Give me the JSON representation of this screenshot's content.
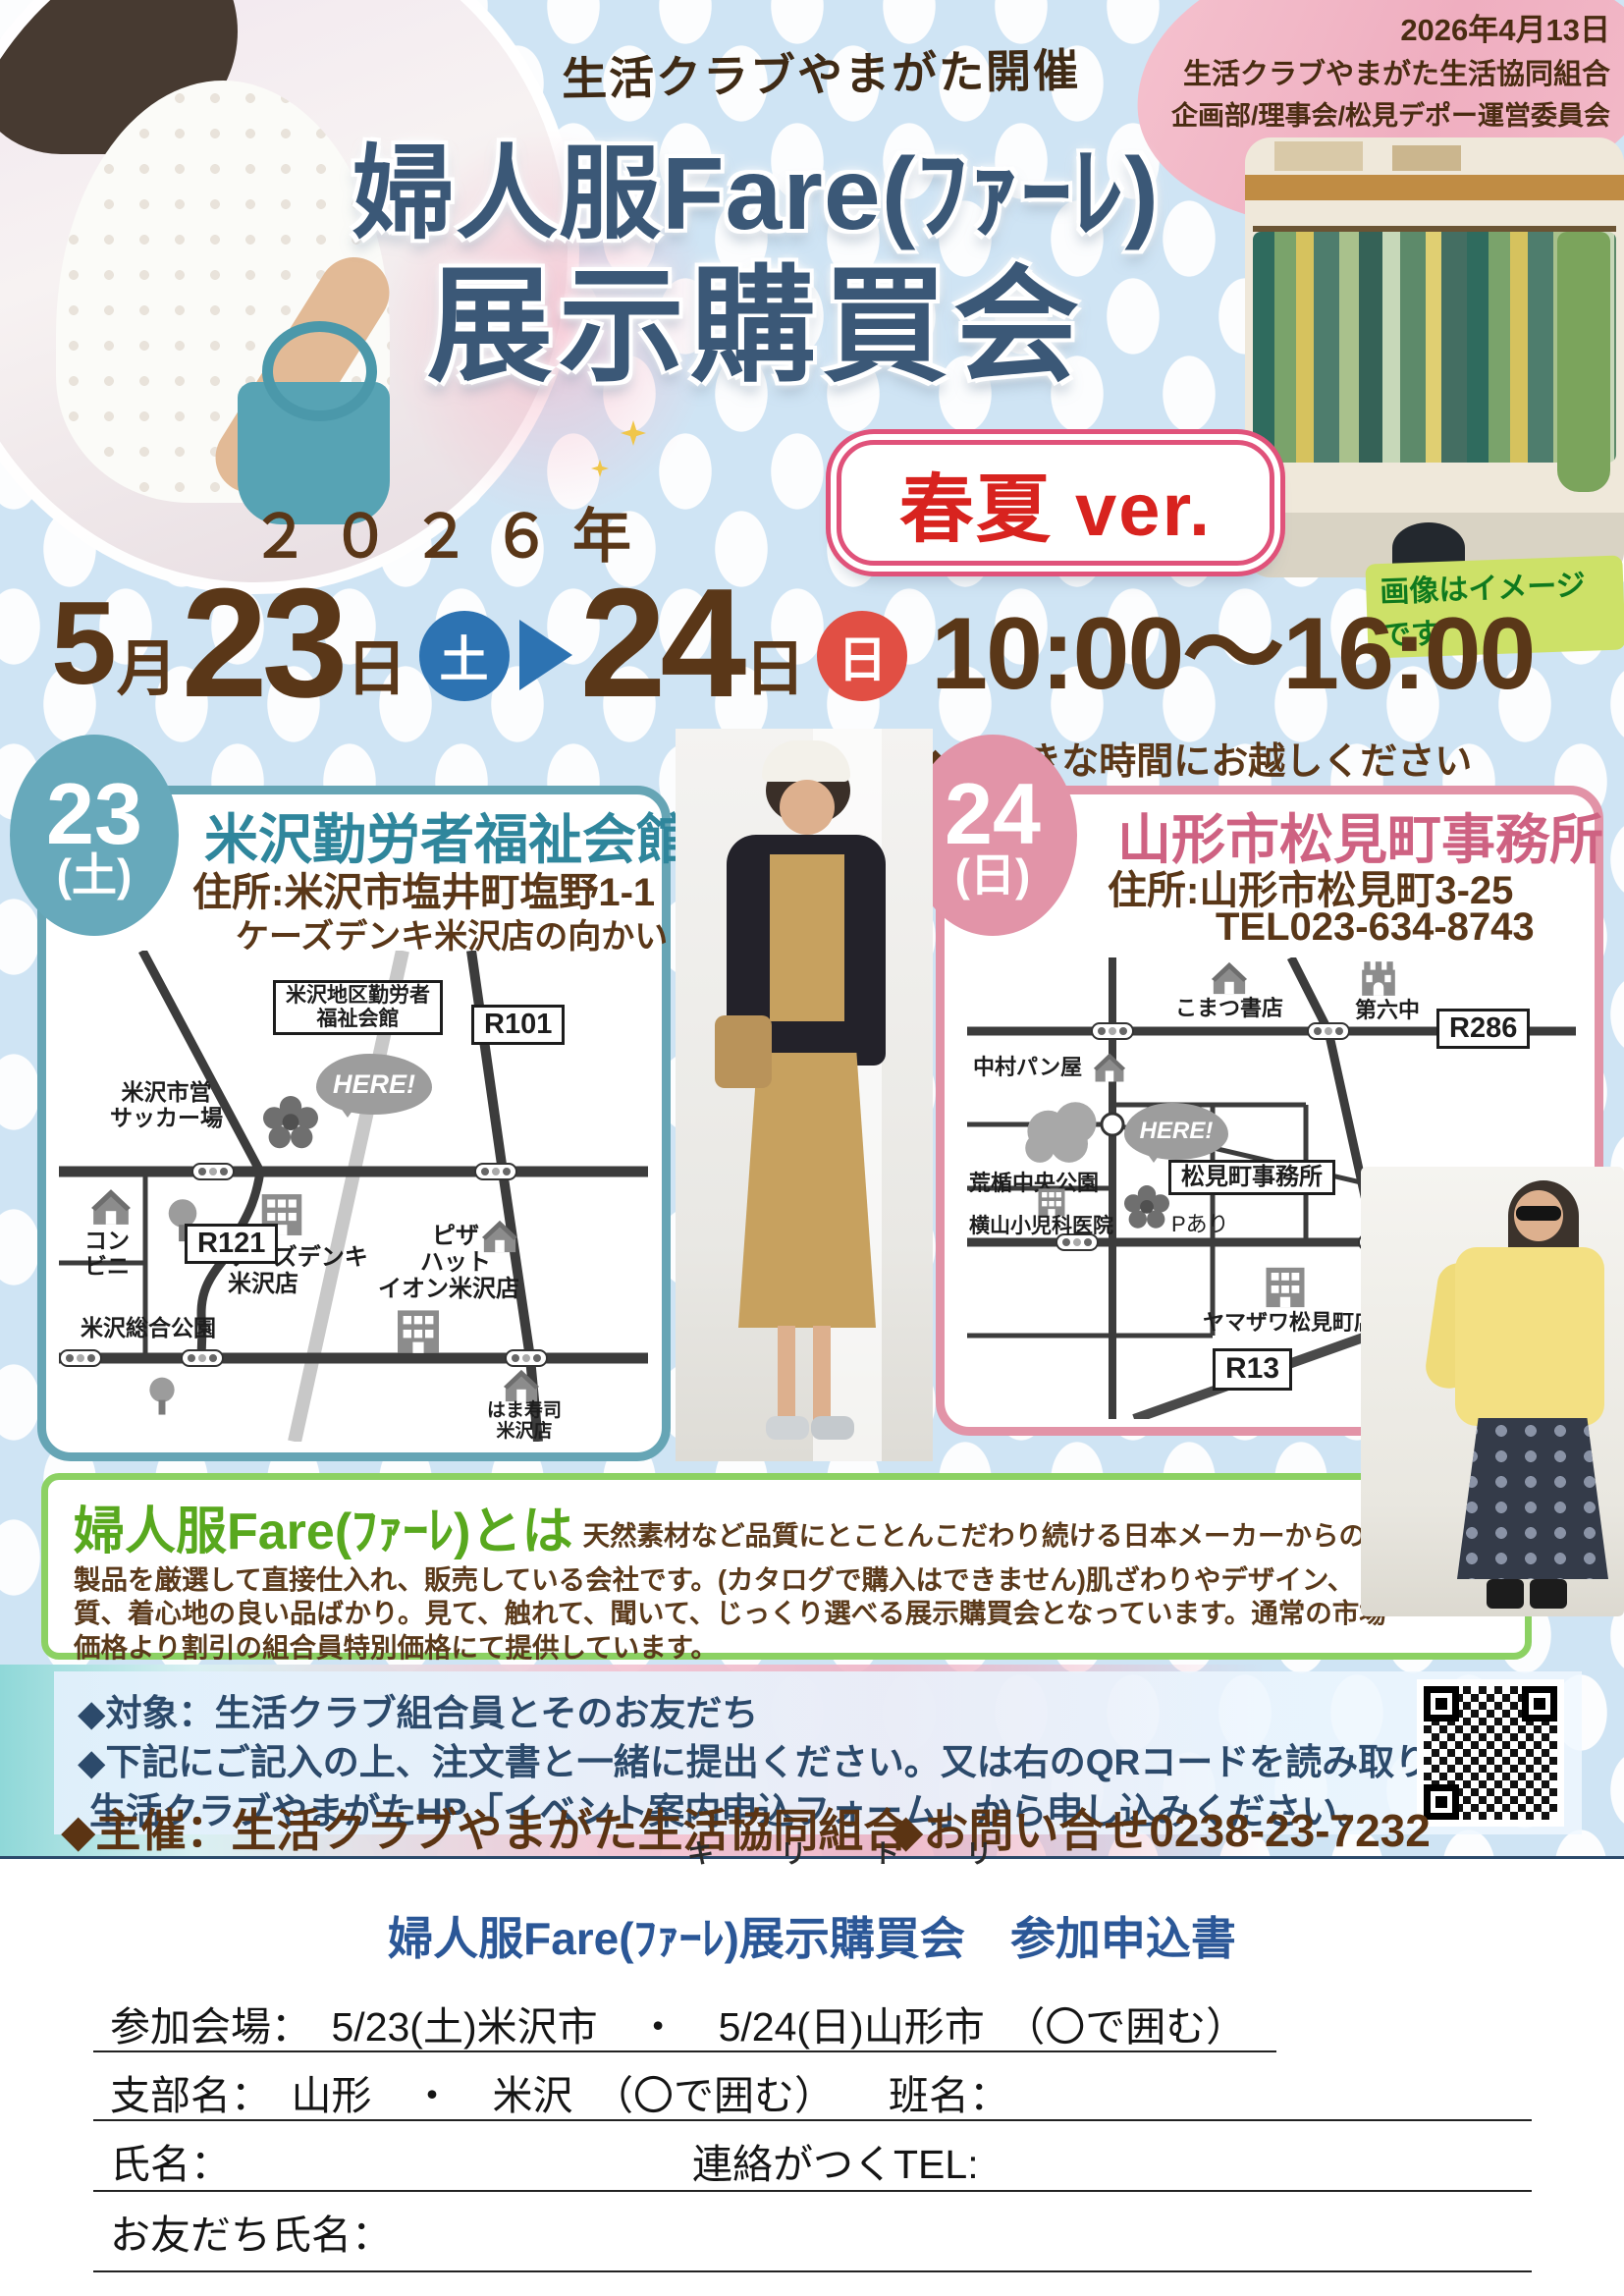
{
  "meta": {
    "issue_date": "2026年4月13日",
    "org_line1": "生活クラブやまがた生活協同組合",
    "org_line2": "企画部/理事会/松見デポー運営委員会",
    "host_note": "生活クラブやまがた開催"
  },
  "title": {
    "line1": "婦人服Fare(ﾌｧｰﾚ)",
    "line2": "展示購買会",
    "season_badge": "春夏 ver.",
    "image_note": "画像はイメージです"
  },
  "schedule": {
    "year": "２０２６年",
    "month_num": "5",
    "month_unit": "月",
    "day1": "23",
    "day1_unit": "日",
    "day1_dow": "土",
    "day2": "24",
    "day2_unit": "日",
    "day2_dow": "日",
    "time": "10:00～16:00",
    "time_note": "◆お好きな時間にお越しください"
  },
  "venues": [
    {
      "day": "23",
      "dow": "(土)",
      "name": "米沢勤労者福祉会館",
      "address": "住所:米沢市塩井町塩野1-1",
      "note": "ケーズデンキ米沢店の向かい",
      "map": {
        "facility": "米沢地区勤労者\n福祉会館",
        "here": "HERE!",
        "r101": "R101",
        "soccer": "米沢市営\nサッカー場",
        "conbini": "コン\nビニ",
        "ksdenki": "ケーズデンキ\n米沢店",
        "pizza": "ピザ\nハット",
        "park": "米沢総合公園",
        "r121": "R121",
        "aeon": "イオン米沢店",
        "hamazushi": "はま寿司\n米沢店"
      }
    },
    {
      "day": "24",
      "dow": "(日)",
      "name": "山形市松見町事務所",
      "address": "住所:山形市松見町3-25",
      "tel": "TEL023-634-8743",
      "map": {
        "komatsu": "こまつ書店",
        "school": "第六中",
        "r286": "R286",
        "bakery": "中村パン屋",
        "park": "荒楯中央公園",
        "here": "HERE!",
        "office": "松見町事務所",
        "parking": "Pあり",
        "clinic": "横山小児科医院",
        "yamazawa": "ヤマザワ松見町店",
        "r13": "R13"
      }
    }
  ],
  "about": {
    "title": "婦人服Fare(ﾌｧｰﾚ)とは",
    "body": "天然素材など品質にとことんこだわり続ける日本メーカーからの製品を厳選して直接仕入れ、販売している会社です。(カタログで購入はできません)肌ざわりやデザイン、質、着心地の良い品ばかり。見て、触れて、聞いて、じっくり選べる展示購買会となっています。通常の市場価格より割引の組合員特別価格にて提供しています。"
  },
  "apply": {
    "line1": "◆対象：生活クラブ組合員とそのお友だち",
    "line2": "◆下記にご記入の上、注文書と一緒に提出ください。又は右のQRコードを読み取り、",
    "line3": "生活クラブやまがたHP「イベント案内申込フォーム」から申し込みください。"
  },
  "footer": {
    "organizer": "◆主催：生活クラブやまがた生活協同組合",
    "contact": "◆お問い合せ0238-23-7232",
    "cutline": "キ リ ト リ"
  },
  "form": {
    "title": "婦人服Fare(ﾌｧｰﾚ)展示購買会　参加申込書",
    "row1": "参加会場：　5/23(土)米沢市　・　5/24(日)山形市　（〇で囲む）",
    "row2a": "支部名：　山形　・　米沢　（〇で囲む）",
    "row2b": "班名：",
    "row3a": "氏名：",
    "row3b": "連絡がつくTEL:",
    "row4": "お友だち氏名："
  },
  "colors": {
    "title_blue": "#3b5877",
    "brown": "#5a3718",
    "teal": "#67a9bb",
    "pink": "#e294a8",
    "red": "#d8231f",
    "green": "#8cd163"
  }
}
